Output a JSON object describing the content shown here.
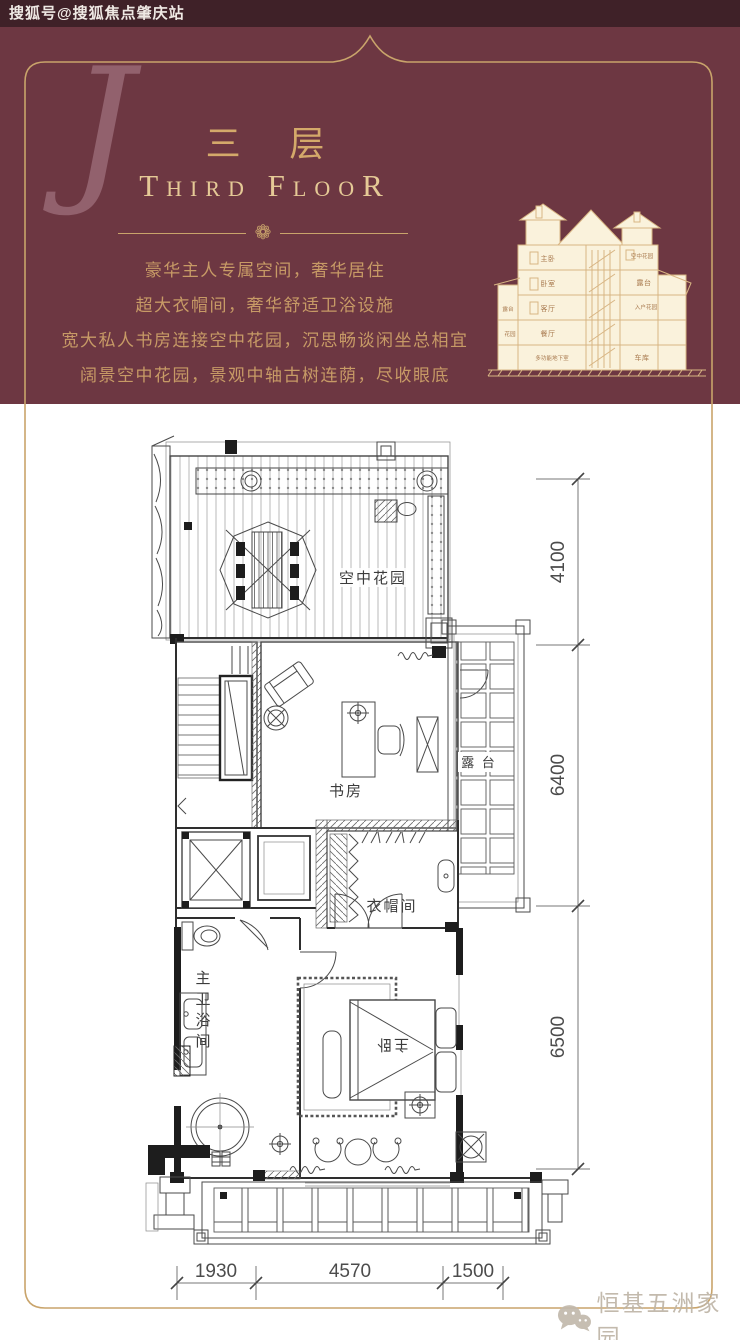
{
  "topbar": {
    "text": "搜狐号@搜狐焦点肇庆站"
  },
  "theme": {
    "maroon": "#6d3742",
    "topbar_dark": "#3f2128",
    "gold": "#c9a46b",
    "gold_title": "#d4a96a",
    "gold_text": "#c79a66",
    "plan_line": "#4a4a4a"
  },
  "header": {
    "monogram": "J",
    "title_cn": "三 层",
    "title_en": "Third FlooR",
    "divider_flower": "❁",
    "description_lines": [
      "豪华主人专属空间，奢华居住",
      "超大衣帽间，奢华舒适卫浴设施",
      "宽大私人书房连接空中花园，沉思畅谈闲坐总相宜",
      "阔景空中花园，景观中轴古树连荫，尽收眼底"
    ],
    "section_labels": {
      "master": "主卧",
      "sky_garden": "空中花园",
      "bedroom": "卧室",
      "terrace": "露台",
      "living": "客厅",
      "entry_garden": "入户花园",
      "dining": "餐厅",
      "basement": "多功能地下室",
      "garage": "车库",
      "terrace_left": "露台",
      "garden_left": "花园"
    }
  },
  "plan": {
    "rooms": {
      "sky_garden": "空中花园",
      "study": "书房",
      "terrace": "露 台",
      "cloakroom": "衣帽间",
      "master_bath": "主卫浴间",
      "master_bed": "主卧"
    },
    "dims": {
      "right": [
        "4100",
        "6400",
        "6500"
      ],
      "bottom": [
        "1930",
        "4570",
        "1500"
      ]
    }
  },
  "footer": {
    "watermark": "恒基五洲家园"
  }
}
